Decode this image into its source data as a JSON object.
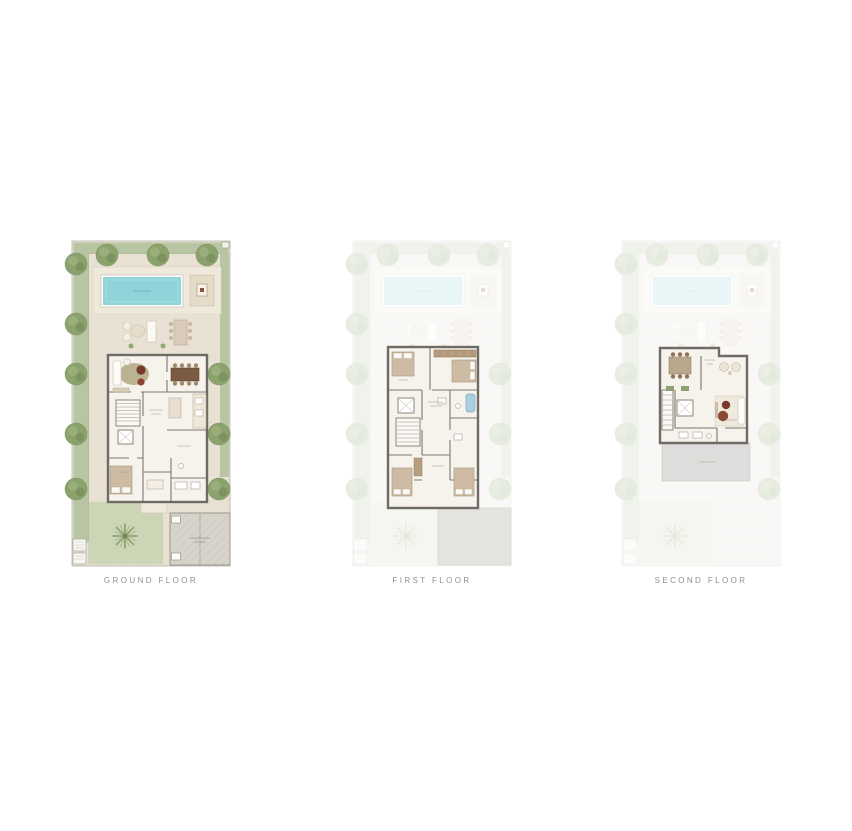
{
  "plans": [
    {
      "id": "ground",
      "label": "GROUND FLOOR",
      "active": true
    },
    {
      "id": "first",
      "label": "FIRST FLOOR",
      "active": false
    },
    {
      "id": "second",
      "label": "SECOND FLOOR",
      "active": false
    }
  ],
  "colors": {
    "background": "#ffffff",
    "label_text": "#8f8f8f",
    "paving": "#e8e1d4",
    "garden_green": "#b8c5a3",
    "garden_green_light": "#ccd5b6",
    "tree_green": "#8ba26d",
    "pool_water": "#8ed4d9",
    "wall": "#6f6a63",
    "interior_floor": "#f6f2ec",
    "terrace_gray": "#dddddb",
    "garage_gray": "#d8d4cb",
    "faded_opacity": "0.2"
  }
}
